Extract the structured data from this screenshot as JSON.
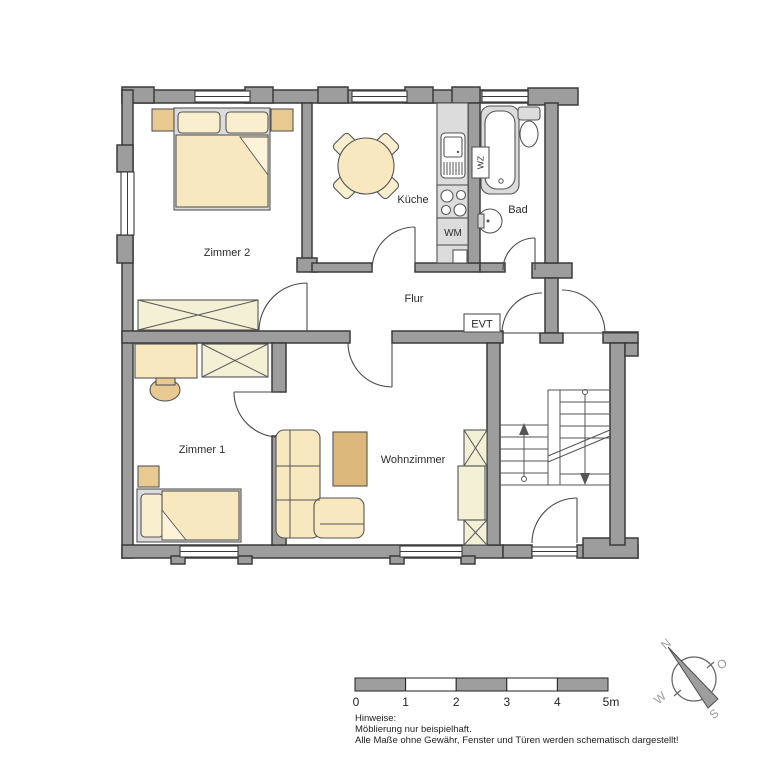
{
  "plan_type": "apartment-floor-plan",
  "rooms": {
    "zimmer2": "Zimmer 2",
    "kueche": "Küche",
    "bad": "Bad",
    "flur": "Flur",
    "zimmer1": "Zimmer 1",
    "wohnzimmer": "Wohnzimmer"
  },
  "fixture_labels": {
    "wm": "WM",
    "wz": "WZ",
    "evt": "EVT"
  },
  "scale_bar": {
    "ticks": [
      "0",
      "1",
      "2",
      "3",
      "4",
      "5m"
    ],
    "segments": 5
  },
  "compass": {
    "north": "N",
    "east": "O",
    "south": "S",
    "west": "W"
  },
  "notes": {
    "heading": "Hinweise:",
    "line1": "Möblierung nur beispielhaft.",
    "line2": "Alle Maße ohne Gewähr, Fenster und Türen werden schematisch dargestellt!"
  },
  "colors": {
    "wall": "#9d9d9d",
    "wall_outline": "#3b3b3b",
    "furniture_cream": "#f8e8c0",
    "furniture_tan": "#e9c992",
    "coffee_table_tan": "#dcb87c",
    "wardrobe_pale": "#f4f0d6",
    "counter_gray": "#dcdcdc",
    "scale_gray": "#9e9e9e"
  }
}
